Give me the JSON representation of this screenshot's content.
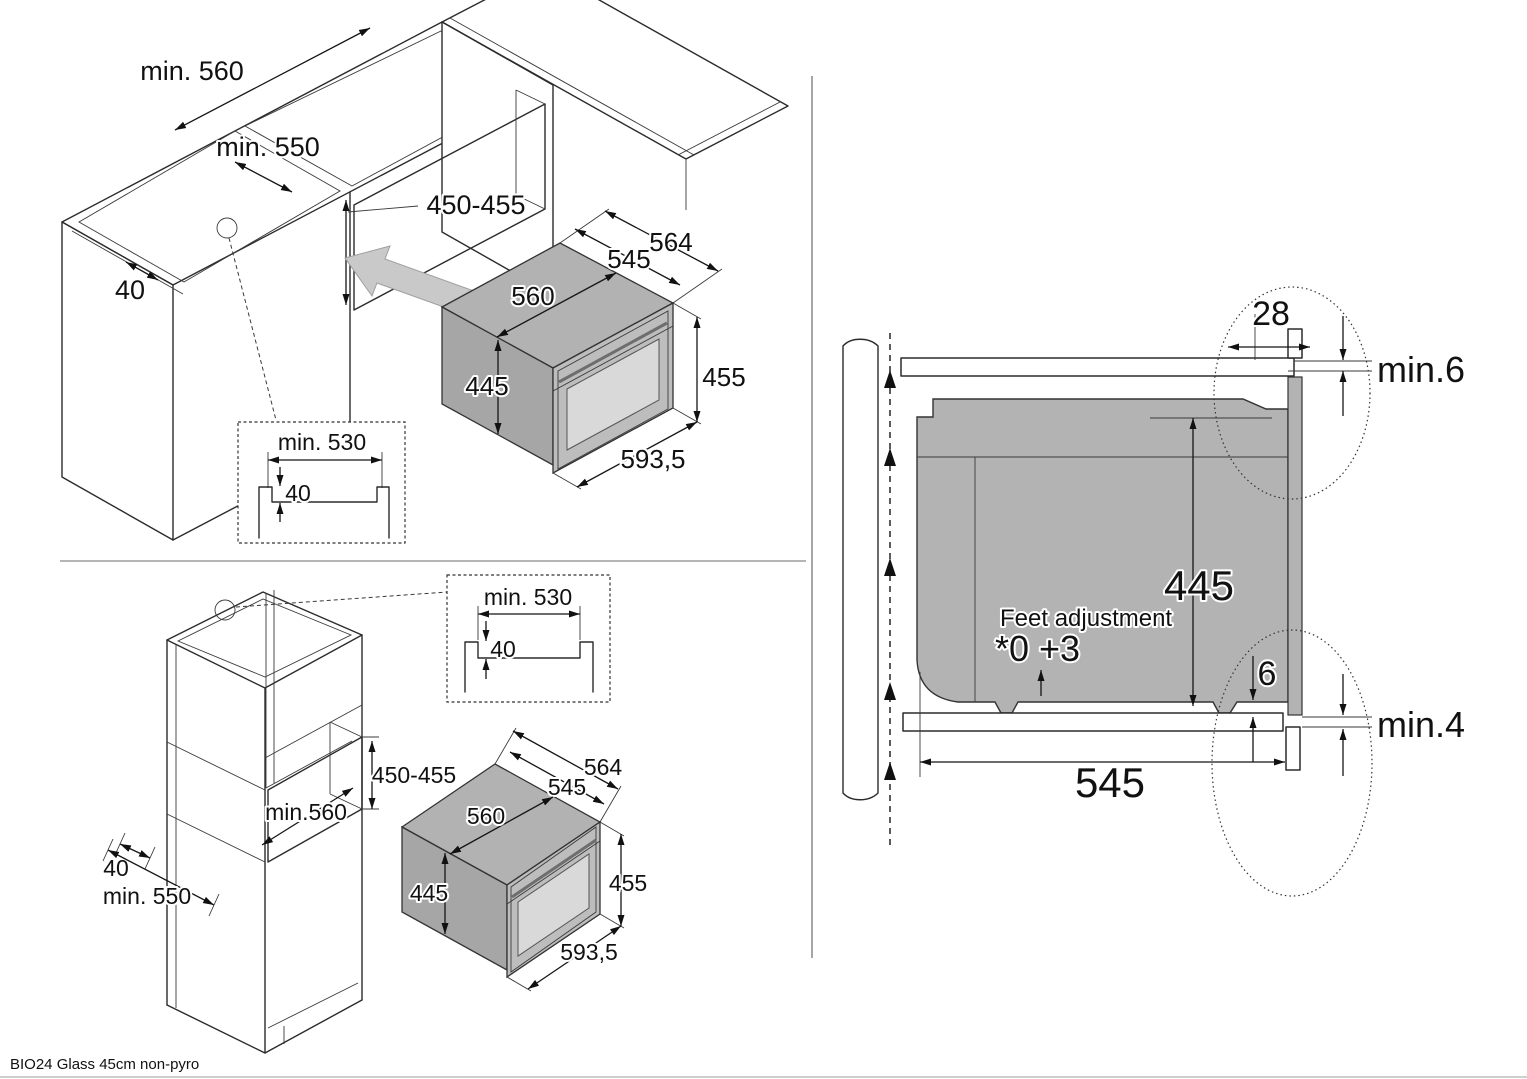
{
  "page": {
    "footer_model": "BIO24 Glass 45cm non-pyro"
  },
  "colors": {
    "oven_top": "#b2b2b2",
    "oven_side": "#a6a6a6",
    "oven_front": "#bdbdbd",
    "oven_glass": "#d9d9d9",
    "section_body": "#b3b3b3",
    "insert_arrow": "#c9c9c9",
    "line": "#1a1a1a"
  },
  "built_in_view": {
    "niche_min_width": "min. 560",
    "niche_min_depth": "min. 550",
    "niche_height_range": "450-455",
    "rail_offset": "40",
    "detail_inset": {
      "min_width": "min. 530",
      "recess_depth": "40"
    },
    "oven": {
      "overall_width": "564",
      "body_width": "545",
      "body_depth": "560",
      "body_height": "445",
      "overall_height": "455",
      "front_width": "593,5"
    }
  },
  "tall_unit_view": {
    "niche_height_range": "450-455",
    "niche_min_width": "min.560",
    "rail_offset": "40",
    "cabinet_min_depth": "min. 550",
    "detail_inset": {
      "min_width": "min. 530",
      "recess_depth": "40"
    },
    "oven": {
      "overall_width": "564",
      "body_width": "545",
      "body_depth": "560",
      "body_height": "445",
      "overall_height": "455",
      "front_width": "593,5"
    }
  },
  "side_section_view": {
    "front_overhang": "28",
    "top_clearance": "min.6",
    "oven_height": "445",
    "feet_adjustment_label": "Feet adjustment",
    "feet_adjustment_range": "*0 +3",
    "fascia_drop": "6",
    "bottom_clearance": "min.4",
    "support_depth": "545"
  }
}
